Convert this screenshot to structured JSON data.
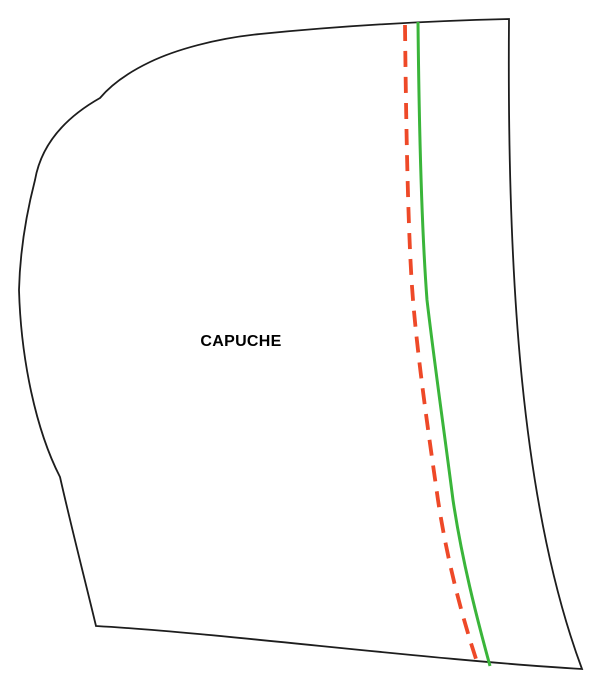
{
  "pattern_piece": {
    "label": "CAPUCHE"
  },
  "colors": {
    "outline": "#1d1d1d",
    "solid_guide": "#3ab53a",
    "dashed_guide": "#ee4928",
    "label": "#000000",
    "background": "#ffffff"
  }
}
